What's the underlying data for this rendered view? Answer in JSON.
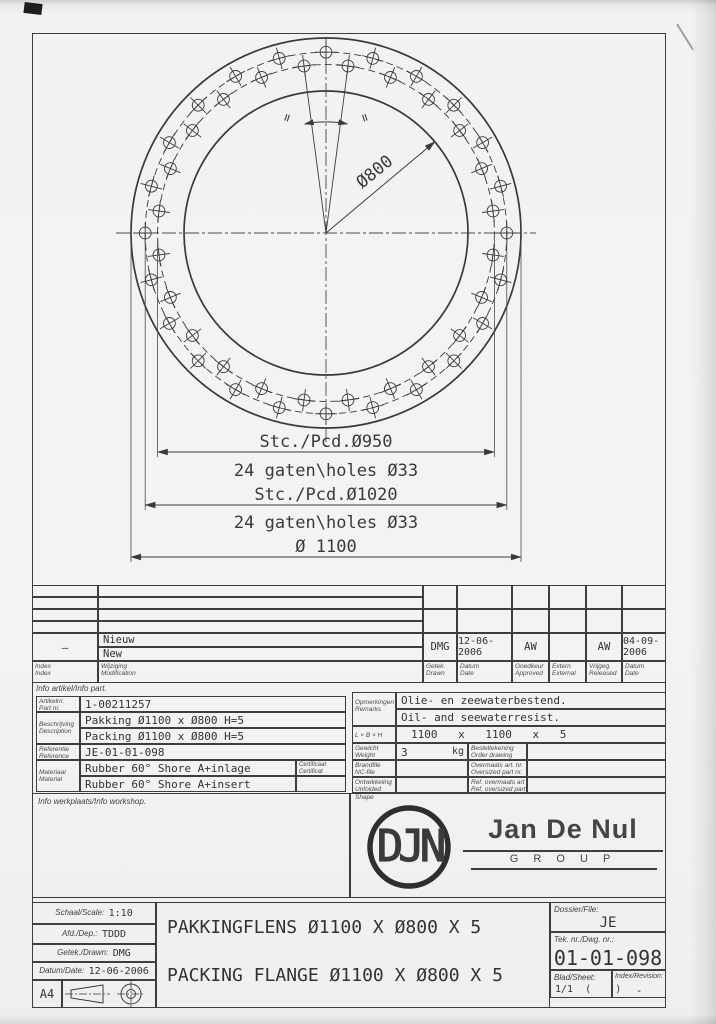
{
  "colors": {
    "ink": "#3e3e3e",
    "paper": "#f2f3f1"
  },
  "drawing": {
    "dim_bore": "Ø800",
    "pcd1": "Stc./Pcd.Ø950",
    "pcd1_holes": "24 gaten\\holes Ø33",
    "pcd2": "Stc./Pcd.Ø1020",
    "pcd2_holes": "24 gaten\\holes Ø33",
    "dim_outer": "Ø 1100",
    "equal_left": "=",
    "equal_right": "="
  },
  "revision": {
    "headers": {
      "index": "Index\nIndex",
      "change": "Wijziging\nModification",
      "drawn": "Getek.\nDrawn",
      "date": "Datum\nDate",
      "approved": "Goedkeur\nApproved",
      "external": "Extern\nExternal",
      "released": "Vrijgeg.\nReleased",
      "date2": "Datum\nDate"
    },
    "row": {
      "index": "—",
      "change_nl": "Nieuw",
      "change_en": "New",
      "drawn": "DMG",
      "date": "12-06-2006",
      "approved": "AW",
      "external": "",
      "released": "AW",
      "release_date": "04-09-2006"
    }
  },
  "info_part": {
    "title": "Info artikel/Info part.",
    "part_label": "Artikelnr.\nPart nr.",
    "part_nr": "1-00211257",
    "desc_label": "Beschrijving\nDescription",
    "desc_nl": "Pakking Ø1100 x Ø800 H=5",
    "desc_en": "Packing Ø1100 x Ø800 H=5",
    "ref_label": "Referentie\nReference",
    "ref": "JE-01-01-098",
    "mat_label": "Materiaal\nMaterial",
    "mat_nl": "Rubber 60° Shore A+inlage",
    "mat_en": "Rubber 60° Shore A+insert",
    "cert_label": "Certificaat\nCertificat"
  },
  "specs": {
    "remarks_label": "Opmerkingen\nRemarks",
    "remark_nl": "Olie- en zeewaterbestend.",
    "remark_en": "Oil- and seewaterresist.",
    "lbh_label": "L × B × H",
    "lbh": "1100 x 1100 x 5",
    "weight_label": "Gewicht\nWeight",
    "weight": "3",
    "weight_unit": "kg",
    "brandfile_label": "Brandfile\nNC-file",
    "unfolded_label": "Ontwikkeling\nUnfolded Shape",
    "order_label": "Besteltekening\nOrder drawing",
    "oversized_label": "Overmaats art. nr.\nOversized part nr.",
    "ref_oversized_label": "Ref. overmaats art\nRef. oversized part"
  },
  "workshop": {
    "title": "Info werkplaats/Info workshop."
  },
  "logo": {
    "monogram": "DJN",
    "name": "Jan De Nul",
    "group": "G R O U P"
  },
  "titleblock": {
    "scale_label": "Schaal/Scale:",
    "scale": "1:10",
    "dep_label": "Afd./Dep.:",
    "dep": "TDDD",
    "drawn_label": "Getek./Drawn:",
    "drawn": "DMG",
    "date_label": "Datum/Date:",
    "date": "12-06-2006",
    "format": "A4",
    "title_nl": "PAKKINGFLENS Ø1100 X Ø800 X 5",
    "title_en": "PACKING FLANGE Ø1100 X Ø800 X 5",
    "dossier_label": "Dossier/File:",
    "dossier": "JE",
    "dwg_label": "Tek. nr./Dwg. nr.:",
    "dwg_nr": "01-01-098",
    "sheet_label": "Blad/Sheet:",
    "sheet": "1/1  (    )",
    "rev_label": "Index/Revision:",
    "rev": "-"
  }
}
